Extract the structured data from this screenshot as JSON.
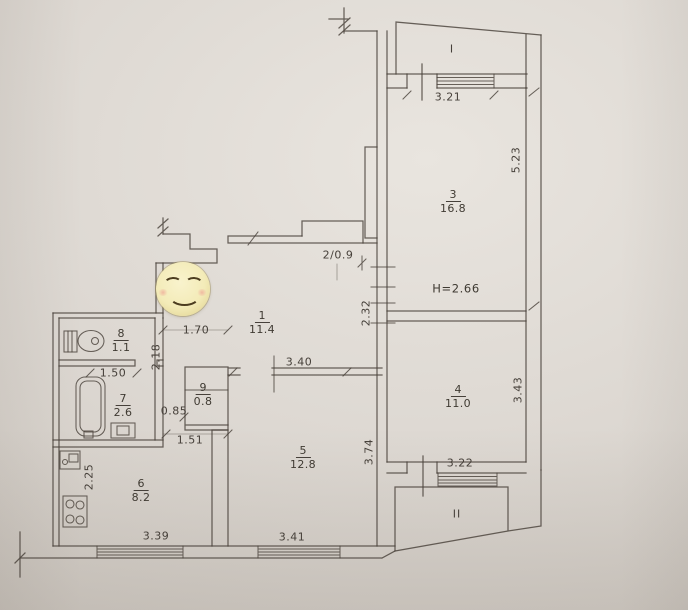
{
  "plan": {
    "balconies": {
      "first": "I",
      "second": "II"
    },
    "height_note": "H=2.66",
    "closet2_label": "2/0.9",
    "rooms": {
      "r1": {
        "num": "1",
        "area": "11.4"
      },
      "r3": {
        "num": "3",
        "area": "16.8"
      },
      "r4": {
        "num": "4",
        "area": "11.0"
      },
      "r5": {
        "num": "5",
        "area": "12.8"
      },
      "r6": {
        "num": "6",
        "area": "8.2"
      },
      "r7": {
        "num": "7",
        "area": "2.6"
      },
      "r8": {
        "num": "8",
        "area": "1.1"
      },
      "r9": {
        "num": "9",
        "area": "0.8"
      }
    },
    "dims": {
      "d321": "3.21",
      "d523": "5.23",
      "d232": "2.32",
      "d170": "1.70",
      "d218": "2.18",
      "d150": "1.50",
      "d085": "0.85",
      "d151": "1.51",
      "d340": "3.40",
      "d374": "3.74",
      "d343": "3.43",
      "d322": "3.22",
      "d225": "2.25",
      "d339": "3.39",
      "d341": "3.41"
    },
    "icons": {
      "smiley": "smiling-face-emoji-sticker",
      "fixtures": [
        "toilet-icon",
        "bathtub-icon",
        "washbasin-icon",
        "kitchen-sink-icon",
        "stove-icon"
      ]
    },
    "colors": {
      "paper": "#ddd8d2",
      "line": "#49423a",
      "smiley": "#f3ebb8"
    }
  }
}
